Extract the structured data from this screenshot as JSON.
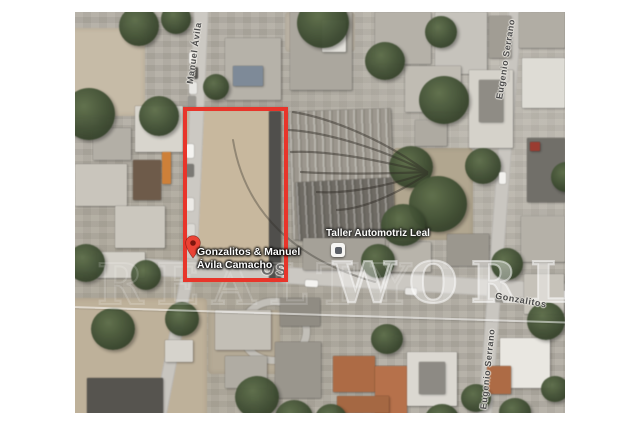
{
  "map": {
    "pin": {
      "label_line1": "Gonzalitos & Manuel",
      "label_line2": "Ávila Camacho",
      "color": "#ea4335",
      "color_inner": "#7c150d"
    },
    "poi": {
      "label": "Taller Automotriz Leal"
    },
    "streets": {
      "left_vertical": "Manuel Ávila",
      "right_vertical_top": "Eugenio Serrano",
      "right_vertical_bottom": "Eugenio Serrano",
      "main_horizontal": "Gonzalitos",
      "main_horizontal_large_fragment": "OS"
    },
    "watermark": {
      "left_word": "REALTY",
      "right_word": "WORLD"
    },
    "highlight": {
      "color": "#e8352a"
    }
  }
}
